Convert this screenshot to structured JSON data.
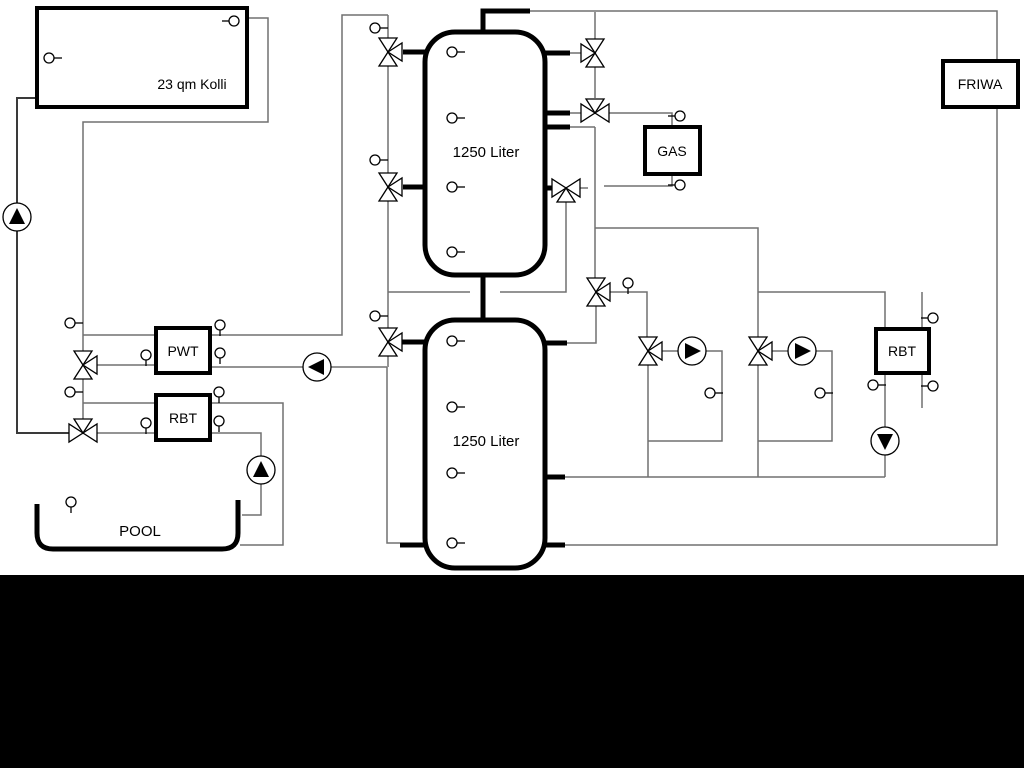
{
  "diagram": {
    "labels": {
      "collector": "23 qm Kolli",
      "tank_top": "1250 Liter",
      "tank_bottom": "1250 Liter",
      "gas": "GAS",
      "friwa": "FRIWA",
      "pwt": "PWT",
      "rbt_left": "RBT",
      "rbt_right": "RBT",
      "pool": "POOL"
    },
    "colors": {
      "pipe_thin": "#707070",
      "pipe_thick": "#000000",
      "symbol_fill": "#ffffff",
      "background": "#ffffff",
      "bottom_bar": "#000000"
    },
    "components": {
      "storage_tanks": 2,
      "pumps": 6,
      "three_way_valves": 11,
      "temperature_sensors": 29
    }
  }
}
